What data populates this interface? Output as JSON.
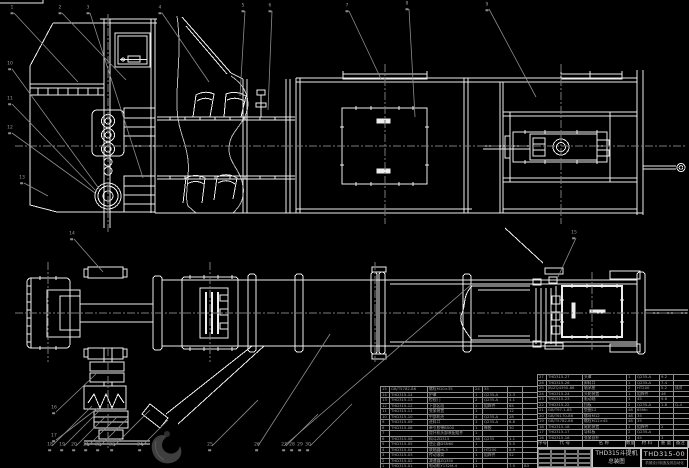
{
  "meta": {
    "background": "#000000",
    "line_color": "#ededed",
    "leader_color": "#8c8c8c",
    "text_color": "#a8a8a8"
  },
  "title_block": {
    "product": "THD315斗提机",
    "subtitle": "总装图",
    "drawing_no": "THD315-00",
    "org": "机械设计制造及其自动化"
  },
  "bom_right_header": [
    "序号",
    "代 号",
    "名  称",
    "数量",
    "材 料",
    "重 量",
    "备注"
  ],
  "bom_left": {
    "rows": [
      [
        "15",
        "GB/T5782-86",
        "螺栓M10×35",
        "24",
        "35",
        "",
        ""
      ],
      [
        "14",
        "THD315-14",
        "护罩",
        "1",
        "Q235-A",
        "2.3",
        ""
      ],
      [
        "13",
        "THD315-13",
        "检视门",
        "2",
        "Q235-A",
        "4.1",
        ""
      ],
      [
        "12",
        "THD315-12",
        "下部区段",
        "1",
        "组焊件",
        "65",
        ""
      ],
      [
        "11",
        "THD315-11",
        "张紧装置",
        "1",
        "",
        "12",
        ""
      ],
      [
        "10",
        "THD315-10",
        "中部机壳",
        "4",
        "Q235-A",
        "28",
        ""
      ],
      [
        "9",
        "THD315-09",
        "进料口",
        "1",
        "Q235-A",
        "6.8",
        ""
      ],
      [
        "8",
        "THD315-08",
        "牵引胶带B500",
        "1",
        "橡胶",
        "30",
        ""
      ],
      [
        "7",
        "",
        "提升机头部装配组件",
        "1",
        "",
        "",
        ""
      ],
      [
        "6",
        "THD315-06",
        "料斗ZD315",
        "38",
        "Q235",
        "1.1",
        ""
      ],
      [
        "5",
        "THD315-05",
        "逆止器DSN60",
        "1",
        "",
        "5.5",
        ""
      ],
      [
        "4",
        "THD315-04",
        "联轴器HL3",
        "1",
        "HT200",
        "8.9",
        ""
      ],
      [
        "3",
        "THD315-03",
        "传动滚筒",
        "1",
        "组焊件",
        "52",
        ""
      ],
      [
        "2",
        "THD315-02",
        "减速器ZQ350",
        "1",
        "",
        "",
        ""
      ],
      [
        "1",
        "THD315-01",
        "电动机Y132M-4",
        "1",
        "",
        "7.5",
        "B3"
      ]
    ]
  },
  "bom_right": {
    "rows": [
      [
        "27",
        "THD315-27",
        "头罩",
        "1",
        "Q235-A",
        "9.2",
        ""
      ],
      [
        "26",
        "THD315-26",
        "卸料口",
        "1",
        "Q235-A",
        "7.4",
        ""
      ],
      [
        "25",
        "JB/ZQ4390-86",
        "轴承座",
        "2",
        "HT200",
        "5.2",
        "成对"
      ],
      [
        "24",
        "THD315-24",
        "头轮装置",
        "1",
        "组焊件",
        "46",
        ""
      ],
      [
        "23",
        "THD315-23",
        "驱动轴",
        "1",
        "45",
        "9.6",
        ""
      ],
      [
        "22",
        "THD315-22",
        "挡板",
        "2",
        "Q235-A",
        "1.8",
        "Q-4"
      ],
      [
        "21",
        "GB/T97.1-85",
        "垫圈12",
        "48",
        "65Mn",
        "",
        ""
      ],
      [
        "20",
        "GB/T6170-86",
        "螺母M12",
        "48",
        "35",
        "",
        ""
      ],
      [
        "19",
        "GB/T5782-86",
        "螺栓M12×45",
        "48",
        "35",
        "",
        ""
      ],
      [
        "18",
        "THD315-18",
        "尾轮装置",
        "1",
        "组焊件",
        "2",
        ""
      ],
      [
        "17",
        "THD315-17",
        "导料板",
        "2",
        "Q235-A",
        "",
        ""
      ],
      [
        "16",
        "THD315-16",
        "张紧丝杆",
        "2",
        "45",
        "3",
        ""
      ]
    ]
  },
  "balloons": [
    {
      "x": 12,
      "y": 10,
      "n": "1"
    },
    {
      "x": 60,
      "y": 10,
      "n": "2"
    },
    {
      "x": 88,
      "y": 10,
      "n": "3"
    },
    {
      "x": 160,
      "y": 10,
      "n": "4"
    },
    {
      "x": 243,
      "y": 8,
      "n": "5"
    },
    {
      "x": 270,
      "y": 8,
      "n": "6"
    },
    {
      "x": 347,
      "y": 8,
      "n": "7"
    },
    {
      "x": 407,
      "y": 6,
      "n": "8"
    },
    {
      "x": 487,
      "y": 7,
      "n": "9"
    },
    {
      "x": 10,
      "y": 66,
      "n": "10"
    },
    {
      "x": 10,
      "y": 101,
      "n": "11"
    },
    {
      "x": 10,
      "y": 130,
      "n": "12"
    },
    {
      "x": 22,
      "y": 180,
      "n": "13"
    },
    {
      "x": 72,
      "y": 236,
      "n": "14"
    },
    {
      "x": 574,
      "y": 235,
      "n": "15"
    },
    {
      "x": 54,
      "y": 410,
      "n": "16"
    },
    {
      "x": 54,
      "y": 438,
      "n": "17"
    },
    {
      "x": 50,
      "y": 447,
      "n": "18"
    },
    {
      "x": 62,
      "y": 447,
      "n": "19"
    },
    {
      "x": 74,
      "y": 447,
      "n": "20"
    },
    {
      "x": 86,
      "y": 447,
      "n": "21"
    },
    {
      "x": 98,
      "y": 447,
      "n": "22"
    },
    {
      "x": 112,
      "y": 447,
      "n": "23"
    },
    {
      "x": 140,
      "y": 447,
      "n": "24"
    },
    {
      "x": 210,
      "y": 447,
      "n": "25"
    },
    {
      "x": 257,
      "y": 447,
      "n": "26"
    },
    {
      "x": 284,
      "y": 447,
      "n": "27"
    },
    {
      "x": 292,
      "y": 447,
      "n": "28"
    },
    {
      "x": 300,
      "y": 447,
      "n": "29"
    },
    {
      "x": 308,
      "y": 447,
      "n": "30"
    }
  ]
}
